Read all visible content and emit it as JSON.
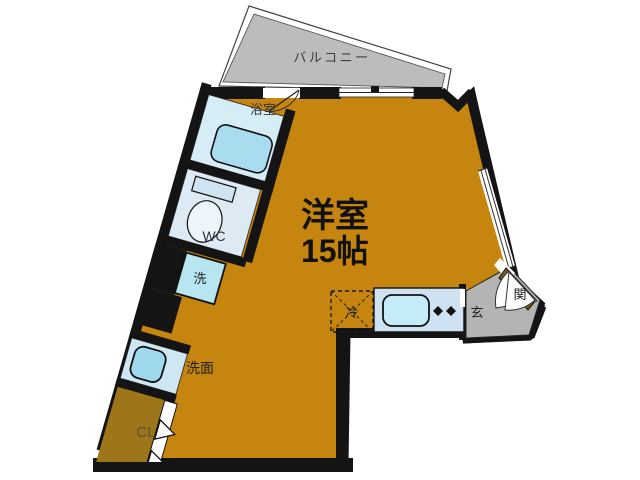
{
  "plan": {
    "balcony": {
      "label": "バルコニー"
    },
    "main_room": {
      "label": "洋室",
      "size": "15帖"
    },
    "bath": {
      "label": "浴室"
    },
    "toilet": {
      "label": "WC"
    },
    "washer": {
      "label": "洗"
    },
    "vanity": {
      "label": "洗面"
    },
    "closet": {
      "label": "CL"
    },
    "fridge": {
      "label": "冷"
    },
    "entrance": {
      "label": "玄関",
      "char1": "玄",
      "char2": "関"
    }
  },
  "colors": {
    "wall": "#141414",
    "room_floor": "#c5850e",
    "closet_floor": "#9c7618",
    "balcony_floor": "#bcbcbc",
    "entry_floor": "#b4b4b4",
    "shoe_cabinet": "#7d5b10",
    "bath_floor": "#d7edf6",
    "tub_blue": "#a9dcee",
    "counter_blue": "#cfe2f2",
    "sink_cyan": "#c4ecf8"
  }
}
